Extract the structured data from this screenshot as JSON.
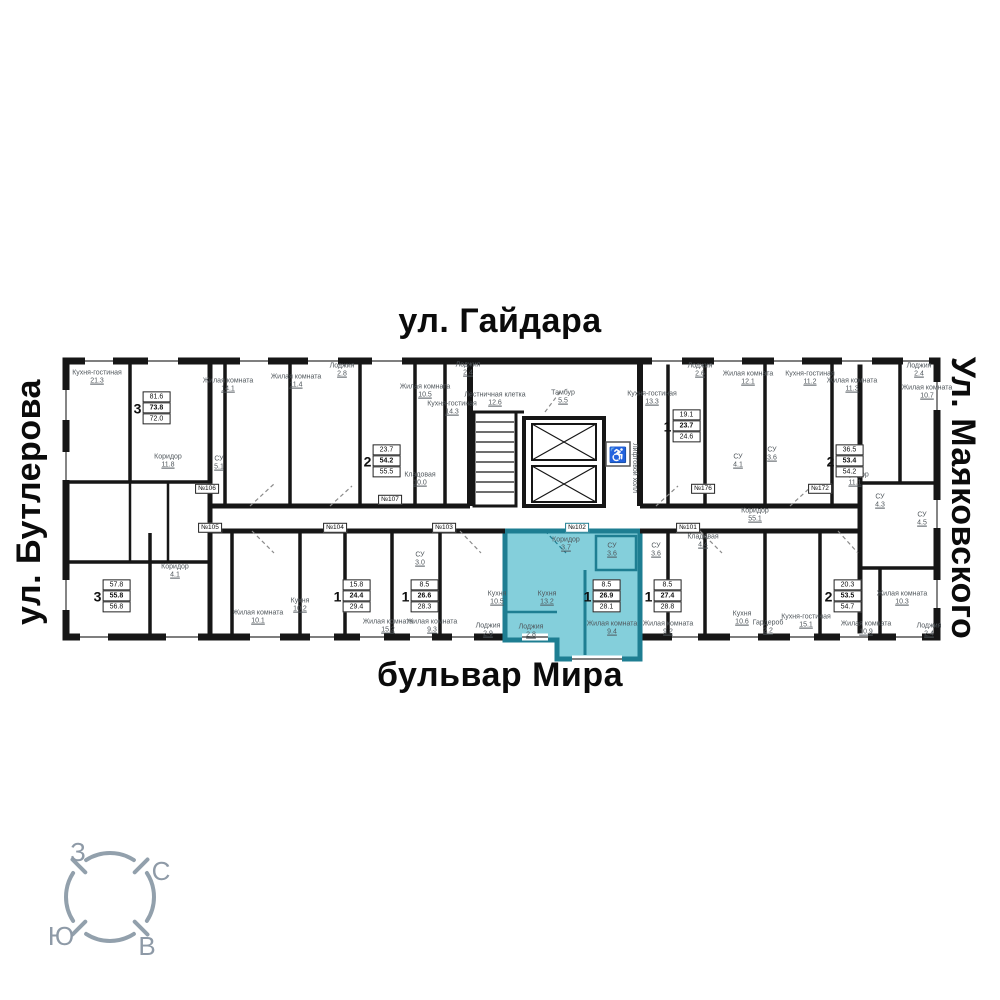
{
  "streets": {
    "top": "ул. Гайдара",
    "right": "Ул. Маяковского",
    "left": "ул. Бутлерова",
    "bottom": "бульвар Мира"
  },
  "compass": {
    "west": "З",
    "north": "С",
    "south": "Ю",
    "east": "В"
  },
  "icons": {
    "accessibility": "♿"
  },
  "colors": {
    "highlight_fill": "#84cfdb",
    "highlight_wall": "#1e7e92",
    "wall": "#161616",
    "room_text": "#50575c",
    "compass": "#92a0ac"
  },
  "selected_apartment": {
    "number": "№102",
    "rooms": "1",
    "area_values": [
      "8.5",
      "26.9",
      "28.1"
    ]
  },
  "apartment_labels": [
    {
      "rooms": "3",
      "values": [
        "81.6",
        "73.8",
        "72.0"
      ],
      "x": 152,
      "y": 408
    },
    {
      "rooms": "2",
      "values": [
        "23.7",
        "54.2",
        "55.5"
      ],
      "x": 382,
      "y": 461
    },
    {
      "rooms": "1",
      "values": [
        "19.1",
        "23.7",
        "24.6"
      ],
      "x": 682,
      "y": 426
    },
    {
      "rooms": "2",
      "values": [
        "36.5",
        "53.4",
        "54.2"
      ],
      "x": 845,
      "y": 461
    },
    {
      "rooms": "3",
      "values": [
        "57.8",
        "55.8",
        "56.8"
      ],
      "x": 112,
      "y": 596
    },
    {
      "rooms": "1",
      "values": [
        "15.8",
        "24.4",
        "29.4"
      ],
      "x": 352,
      "y": 596
    },
    {
      "rooms": "1",
      "values": [
        "8.5",
        "26.6",
        "28.3"
      ],
      "x": 420,
      "y": 596
    },
    {
      "rooms": "1",
      "values": [
        "8.5",
        "26.9",
        "28.1"
      ],
      "x": 602,
      "y": 596,
      "highlighted": true
    },
    {
      "rooms": "1",
      "values": [
        "8.5",
        "27.4",
        "28.8"
      ],
      "x": 663,
      "y": 596
    },
    {
      "rooms": "2",
      "values": [
        "20.3",
        "53.5",
        "54.7"
      ],
      "x": 843,
      "y": 596
    }
  ],
  "unit_plates": [
    {
      "label": "№106",
      "x": 207,
      "y": 489
    },
    {
      "label": "№107",
      "x": 390,
      "y": 500
    },
    {
      "label": "№176",
      "x": 703,
      "y": 489
    },
    {
      "label": "№172",
      "x": 820,
      "y": 489
    },
    {
      "label": "№105",
      "x": 210,
      "y": 528
    },
    {
      "label": "№104",
      "x": 335,
      "y": 528
    },
    {
      "label": "№103",
      "x": 444,
      "y": 528
    },
    {
      "label": "№102",
      "x": 577,
      "y": 528,
      "highlighted": true
    },
    {
      "label": "№101",
      "x": 688,
      "y": 528
    }
  ],
  "room_labels": [
    {
      "name": "Кухня-гостиная",
      "area": "21.3",
      "x": 97,
      "y": 378
    },
    {
      "name": "Жилая комната",
      "area": "14.1",
      "x": 228,
      "y": 386
    },
    {
      "name": "Жилая комната",
      "area": "11.4",
      "x": 296,
      "y": 382
    },
    {
      "name": "Лоджия",
      "area": "2.8",
      "x": 342,
      "y": 371
    },
    {
      "name": "Жилая комната",
      "area": "10.5",
      "x": 425,
      "y": 392
    },
    {
      "name": "Лоджия",
      "area": "2.4",
      "x": 468,
      "y": 370
    },
    {
      "name": "Кухня-гостиная",
      "area": "14.3",
      "x": 452,
      "y": 409
    },
    {
      "name": "Кухня-гостиная",
      "area": "13.3",
      "x": 652,
      "y": 399
    },
    {
      "name": "Лоджия",
      "area": "2.6",
      "x": 700,
      "y": 371
    },
    {
      "name": "Жилая комната",
      "area": "12.1",
      "x": 748,
      "y": 379
    },
    {
      "name": "Кухня-гостиная",
      "area": "11.2",
      "x": 810,
      "y": 379
    },
    {
      "name": "Жилая комната",
      "area": "11.3",
      "x": 852,
      "y": 386
    },
    {
      "name": "Лоджия",
      "area": "2.4",
      "x": 919,
      "y": 371
    },
    {
      "name": "Жилая комната",
      "area": "10.7",
      "x": 927,
      "y": 393
    },
    {
      "name": "Коридор",
      "area": "11.8",
      "x": 168,
      "y": 462
    },
    {
      "name": "СУ",
      "area": "5.1",
      "x": 219,
      "y": 464
    },
    {
      "name": "Кладовая",
      "area": "10.0",
      "x": 420,
      "y": 480
    },
    {
      "name": "СУ",
      "area": "4.1",
      "x": 738,
      "y": 462
    },
    {
      "name": "СУ",
      "area": "3.6",
      "x": 772,
      "y": 455
    },
    {
      "name": "Коридор",
      "area": "11.1",
      "x": 855,
      "y": 480
    },
    {
      "name": "Лестничная клетка",
      "area": "12.6",
      "x": 495,
      "y": 400
    },
    {
      "name": "Тамбур",
      "area": "5.5",
      "x": 563,
      "y": 398
    },
    {
      "name": "Лифтовой холл",
      "area": "",
      "x": 634,
      "y": 468,
      "vertical": true
    },
    {
      "name": "Коридор",
      "area": "55.1",
      "x": 755,
      "y": 516
    },
    {
      "name": "Коридор",
      "area": "4.1",
      "x": 175,
      "y": 572
    },
    {
      "name": "Жилая комната",
      "area": "10.1",
      "x": 258,
      "y": 618
    },
    {
      "name": "Кухня",
      "area": "10.2",
      "x": 300,
      "y": 606
    },
    {
      "name": "Жилая комната",
      "area": "15.2",
      "x": 388,
      "y": 627
    },
    {
      "name": "Жилая комната",
      "area": "9.3",
      "x": 432,
      "y": 627
    },
    {
      "name": "СУ",
      "area": "3.0",
      "x": 420,
      "y": 560
    },
    {
      "name": "Кухня",
      "area": "10.5",
      "x": 497,
      "y": 599
    },
    {
      "name": "Лоджия",
      "area": "2.9",
      "x": 488,
      "y": 631
    },
    {
      "name": "Коридор",
      "area": "3.7",
      "x": 566,
      "y": 545
    },
    {
      "name": "СУ",
      "area": "3.6",
      "x": 612,
      "y": 551
    },
    {
      "name": "Кухня",
      "area": "13.2",
      "x": 547,
      "y": 599
    },
    {
      "name": "Лоджия",
      "area": "2.8",
      "x": 531,
      "y": 632
    },
    {
      "name": "Жилая комната",
      "area": "9.4",
      "x": 612,
      "y": 629
    },
    {
      "name": "СУ",
      "area": "3.6",
      "x": 656,
      "y": 551
    },
    {
      "name": "Жилая комната",
      "area": "9.2",
      "x": 668,
      "y": 629
    },
    {
      "name": "Кладовая",
      "area": "4.4",
      "x": 703,
      "y": 542
    },
    {
      "name": "Кухня",
      "area": "10.6",
      "x": 742,
      "y": 619
    },
    {
      "name": "Гардероб",
      "area": "2.2",
      "x": 768,
      "y": 628
    },
    {
      "name": "Кухня-гостиная",
      "area": "15.1",
      "x": 806,
      "y": 622
    },
    {
      "name": "Жилая комната",
      "area": "10.9",
      "x": 866,
      "y": 629
    },
    {
      "name": "Жилая комната",
      "area": "10.3",
      "x": 902,
      "y": 599
    },
    {
      "name": "СУ",
      "area": "4.3",
      "x": 880,
      "y": 502
    },
    {
      "name": "СУ",
      "area": "4.5",
      "x": 922,
      "y": 520
    },
    {
      "name": "Лоджия",
      "area": "2.4",
      "x": 929,
      "y": 631
    }
  ]
}
